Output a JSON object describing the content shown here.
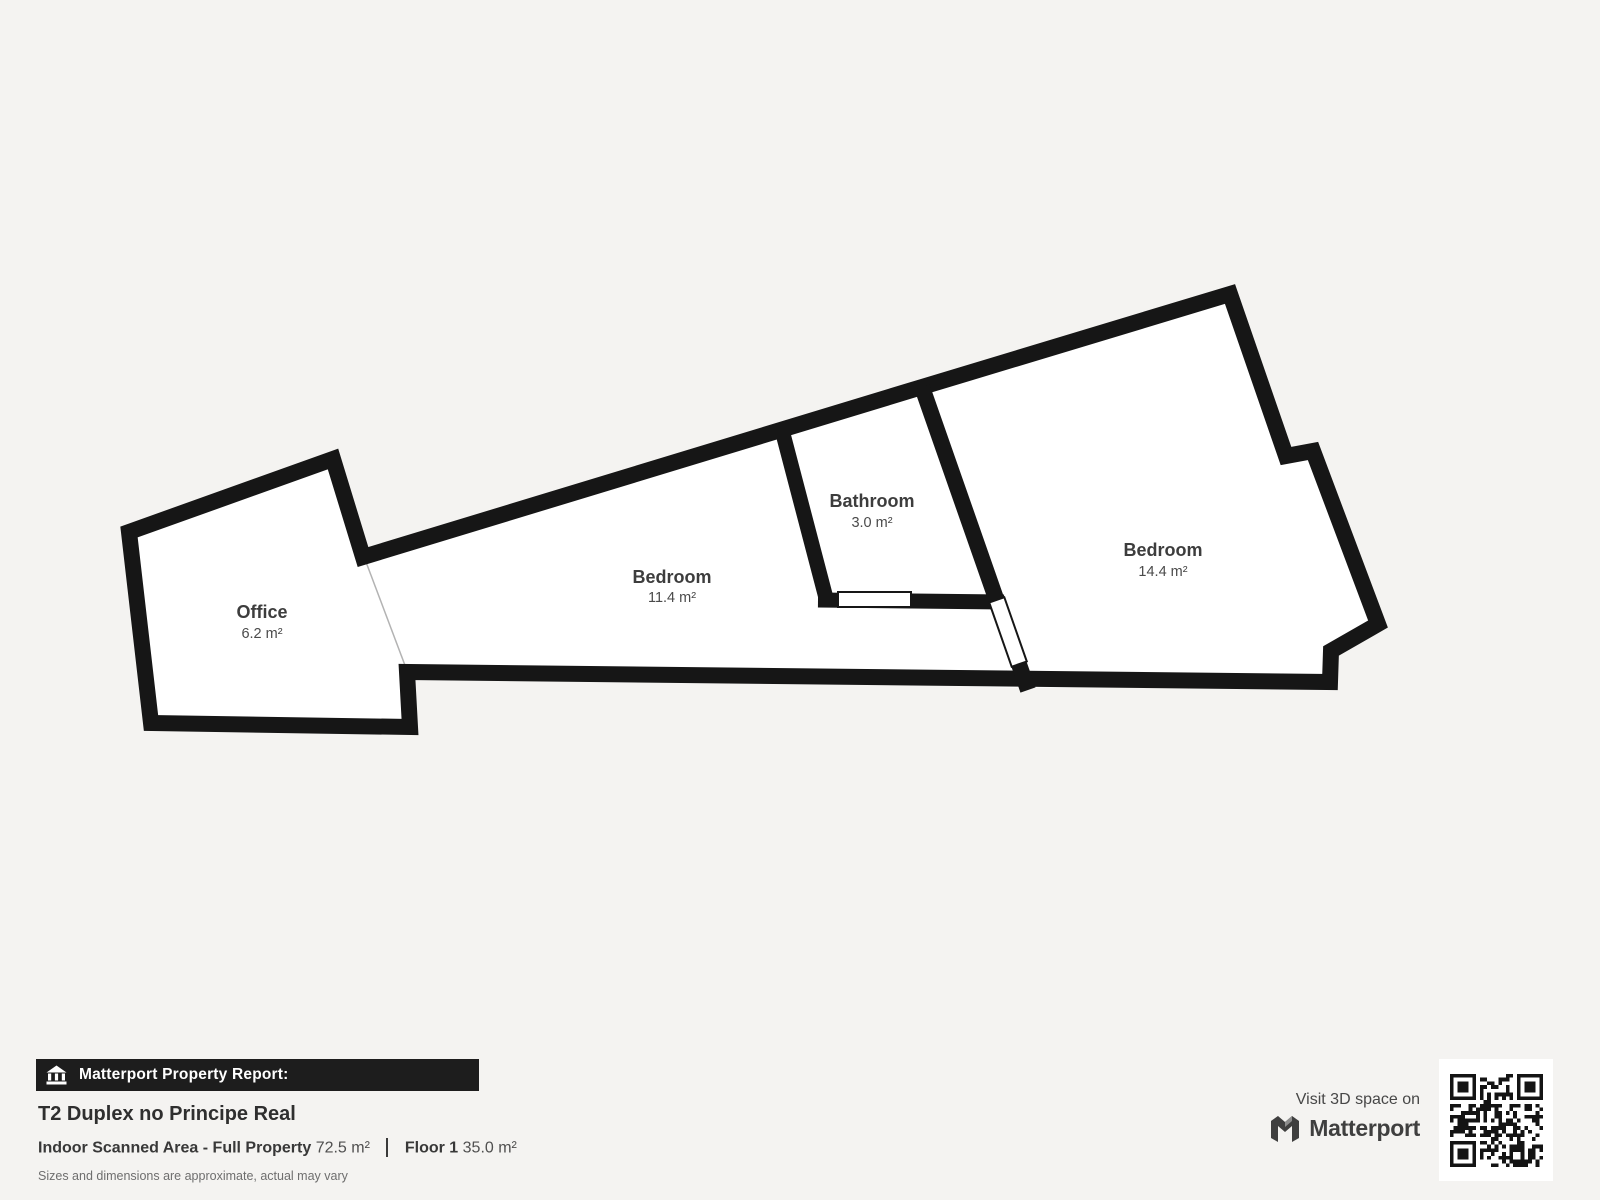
{
  "floorplan": {
    "rooms": [
      {
        "name": "Office",
        "area": "6.2 m²"
      },
      {
        "name": "Bedroom",
        "area": "11.4 m²"
      },
      {
        "name": "Bathroom",
        "area": "3.0 m²"
      },
      {
        "name": "Bedroom",
        "area": "14.4 m²"
      }
    ],
    "colors": {
      "wall": "#161616",
      "room_fill": "#ffffff",
      "background": "#f4f3f1",
      "label": "#3d3d3d",
      "opening_line": "#b3b3b3"
    }
  },
  "report": {
    "header_label": "Matterport Property Report:",
    "title": "T2 Duplex no Principe Real",
    "scanned_area_label": "Indoor Scanned Area - Full Property",
    "scanned_area_value": "72.5 m²",
    "floor_label": "Floor 1",
    "floor_value": "35.0 m²",
    "disclaimer": "Sizes and dimensions are approximate, actual may vary"
  },
  "promo": {
    "visit_text": "Visit 3D space on",
    "brand": "Matterport",
    "icons": {
      "header": "house-icon",
      "logo": "matterport-logo-icon",
      "qr": "qr-code"
    }
  }
}
